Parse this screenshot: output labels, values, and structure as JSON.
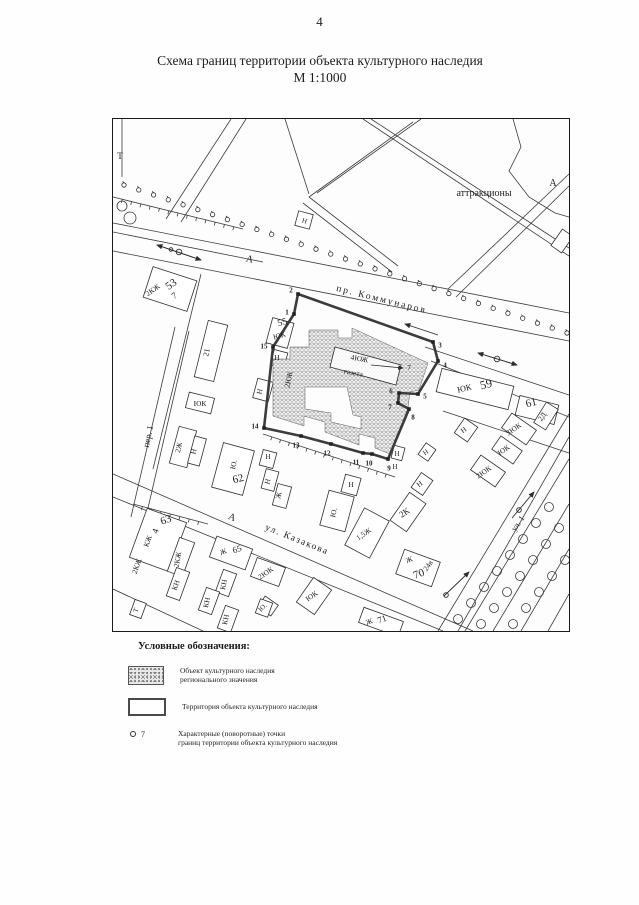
{
  "page": {
    "number": "4",
    "title_line1": "Схема границ территории объекта культурного наследия",
    "title_line2": "М 1:1000"
  },
  "legend": {
    "heading": "Условные обозначения:",
    "items": [
      {
        "swatch": "hatched-area",
        "label": "Объект культурного наследия\nрегионального значения"
      },
      {
        "swatch": "territory-outline",
        "label": "Территория объекта культурного наследия"
      },
      {
        "swatch": "turn-point",
        "marker_number": "7",
        "label": "Характерные (поворотные) точки\nграниц территории объекта культурного наследия"
      }
    ]
  },
  "map": {
    "labels": [
      {
        "t": "Т",
        "x": 7,
        "y": 40,
        "r": 0,
        "s": 9
      },
      {
        "t": "аттракционы",
        "x": 371,
        "y": 77,
        "r": 0,
        "s": 10
      },
      {
        "t": "А",
        "x": 440,
        "y": 67,
        "r": 0,
        "s": 10
      },
      {
        "t": "А",
        "x": 136,
        "y": 143,
        "r": 12,
        "s": 10
      },
      {
        "t": "пр.  Коммунаров",
        "x": 268,
        "y": 183,
        "r": 14,
        "s": 9.5,
        "sp": 2
      },
      {
        "t": "53",
        "x": 60,
        "y": 168,
        "r": -35,
        "s": 11
      },
      {
        "t": "2КЖ",
        "x": 41,
        "y": 173,
        "r": -35,
        "s": 7.5
      },
      {
        "t": "7",
        "x": 63,
        "y": 179,
        "r": -35,
        "s": 9
      },
      {
        "t": "21",
        "x": 96,
        "y": 234,
        "r": -78,
        "s": 8
      },
      {
        "t": "ЮК",
        "x": 87,
        "y": 287,
        "r": 0,
        "s": 7.5
      },
      {
        "t": "55",
        "x": 170,
        "y": 206,
        "r": -15,
        "s": 9.5
      },
      {
        "t": "ЮК",
        "x": 167,
        "y": 219,
        "r": -15,
        "s": 7.5
      },
      {
        "t": "Н",
        "x": 164,
        "y": 241,
        "r": 0,
        "s": 7.5
      },
      {
        "t": "Н",
        "x": 149,
        "y": 273,
        "r": -78,
        "s": 7.5
      },
      {
        "t": "2ЮК",
        "x": 178,
        "y": 261,
        "r": -78,
        "s": 7.5
      },
      {
        "t": "пер. 1",
        "x": 38,
        "y": 318,
        "r": -78,
        "s": 9
      },
      {
        "t": "2Ж",
        "x": 68,
        "y": 329,
        "r": -78,
        "s": 7.5
      },
      {
        "t": "Н",
        "x": 83,
        "y": 333,
        "r": -78,
        "s": 7.5
      },
      {
        "t": "Ю.",
        "x": 123,
        "y": 346,
        "r": -78,
        "s": 7.5
      },
      {
        "t": "62",
        "x": 126,
        "y": 363,
        "r": -15,
        "s": 11
      },
      {
        "t": "Н",
        "x": 155,
        "y": 340,
        "r": 0,
        "s": 7.5
      },
      {
        "t": "Н",
        "x": 157,
        "y": 363,
        "r": -78,
        "s": 7.5
      },
      {
        "t": "Ж",
        "x": 168,
        "y": 377,
        "r": -78,
        "s": 7.5
      },
      {
        "t": "А",
        "x": 118,
        "y": 401,
        "r": 20,
        "s": 10
      },
      {
        "t": "ул.  Казакова",
        "x": 183,
        "y": 423,
        "r": 22,
        "s": 9.5,
        "sp": 1.5
      },
      {
        "t": "63",
        "x": 54,
        "y": 404,
        "r": -20,
        "s": 11
      },
      {
        "t": "4",
        "x": 45,
        "y": 413,
        "r": -70,
        "s": 9
      },
      {
        "t": "КЖ",
        "x": 37,
        "y": 423,
        "r": -70,
        "s": 7.5
      },
      {
        "t": "2КЖ",
        "x": 26,
        "y": 448,
        "r": -70,
        "s": 7.5
      },
      {
        "t": "2КЖ",
        "x": 67,
        "y": 441,
        "r": -80,
        "s": 7.5
      },
      {
        "t": "КН",
        "x": 65,
        "y": 467,
        "r": -70,
        "s": 7.5
      },
      {
        "t": "Т",
        "x": 25,
        "y": 492,
        "r": -70,
        "s": 7
      },
      {
        "t": "Ж",
        "x": 111,
        "y": 435,
        "r": -20,
        "s": 7.5
      },
      {
        "t": "65",
        "x": 125,
        "y": 433,
        "r": -20,
        "s": 9
      },
      {
        "t": "2ЮК",
        "x": 154,
        "y": 456,
        "r": -35,
        "s": 7.5
      },
      {
        "t": "КН",
        "x": 113,
        "y": 466,
        "r": -78,
        "s": 7.5
      },
      {
        "t": "КН",
        "x": 96,
        "y": 484,
        "r": -78,
        "s": 7.5
      },
      {
        "t": "КН",
        "x": 115,
        "y": 501,
        "r": -78,
        "s": 7.5
      },
      {
        "t": "Ю.",
        "x": 151,
        "y": 490,
        "r": -45,
        "s": 7
      },
      {
        "t": "ЮК",
        "x": 200,
        "y": 479,
        "r": -35,
        "s": 7.5
      },
      {
        "t": "Ж",
        "x": 257,
        "y": 505,
        "r": -20,
        "s": 7.5
      },
      {
        "t": "71",
        "x": 270,
        "y": 503,
        "r": -20,
        "s": 9
      },
      {
        "t": "Ю.",
        "x": 223,
        "y": 394,
        "r": -78,
        "s": 7.5
      },
      {
        "t": "Н",
        "x": 238,
        "y": 368,
        "r": 0,
        "s": 7.5
      },
      {
        "t": "1,5Ж",
        "x": 252,
        "y": 417,
        "r": -35,
        "s": 7.5
      },
      {
        "t": "2К",
        "x": 293,
        "y": 396,
        "r": -35,
        "s": 9
      },
      {
        "t": "Н",
        "x": 308,
        "y": 367,
        "r": -35,
        "s": 7.5
      },
      {
        "t": "Н",
        "x": 284,
        "y": 337,
        "r": 0,
        "s": 7
      },
      {
        "t": "Н",
        "x": 282,
        "y": 350,
        "r": 0,
        "s": 7
      },
      {
        "t": "Н",
        "x": 314,
        "y": 335,
        "r": -35,
        "s": 7
      },
      {
        "t": "ЮК",
        "x": 352,
        "y": 272,
        "r": -14,
        "s": 8.5
      },
      {
        "t": "59",
        "x": 374,
        "y": 269,
        "r": -14,
        "s": 12
      },
      {
        "t": "61",
        "x": 419,
        "y": 287,
        "r": -14,
        "s": 11
      },
      {
        "t": "2Д",
        "x": 431,
        "y": 299,
        "r": -55,
        "s": 7.5
      },
      {
        "t": "3ЮК",
        "x": 402,
        "y": 312,
        "r": -35,
        "s": 7.5
      },
      {
        "t": "Н",
        "x": 352,
        "y": 313,
        "r": -35,
        "s": 7.5
      },
      {
        "t": "ЮК",
        "x": 392,
        "y": 333,
        "r": -35,
        "s": 7.5
      },
      {
        "t": "2ЮК",
        "x": 372,
        "y": 355,
        "r": -35,
        "s": 7.5
      },
      {
        "t": "Ж",
        "x": 297,
        "y": 443,
        "r": -20,
        "s": 7.5
      },
      {
        "t": "70",
        "x": 307,
        "y": 458,
        "r": -20,
        "s": 11
      },
      {
        "t": "24в",
        "x": 317,
        "y": 448,
        "r": -55,
        "s": 7.5
      },
      {
        "t": "ул. 1",
        "x": 407,
        "y": 406,
        "r": -55,
        "s": 8.5
      },
      {
        "t": "Н",
        "x": 191,
        "y": 104,
        "r": 15,
        "s": 7
      },
      {
        "t": "4ЮЖ",
        "x": 246,
        "y": 242,
        "r": 10,
        "s": 7.5
      },
      {
        "t": "газета",
        "x": 240,
        "y": 256,
        "r": 10,
        "s": 7.5
      },
      {
        "t": "7",
        "x": 296,
        "y": 251,
        "r": 0,
        "s": 7.5
      }
    ],
    "points": [
      {
        "n": "1",
        "x": 181,
        "y": 195,
        "lx": 174,
        "ly": 193
      },
      {
        "n": "2",
        "x": 185,
        "y": 175,
        "lx": 178,
        "ly": 171
      },
      {
        "n": "3",
        "x": 320,
        "y": 223,
        "lx": 327,
        "ly": 226
      },
      {
        "n": "4",
        "x": 325,
        "y": 242,
        "lx": 332,
        "ly": 246
      },
      {
        "n": "5",
        "x": 305,
        "y": 275,
        "lx": 312,
        "ly": 277
      },
      {
        "n": "6",
        "x": 286,
        "y": 274,
        "lx": 278,
        "ly": 272
      },
      {
        "n": "7",
        "x": 285,
        "y": 284,
        "lx": 277,
        "ly": 288
      },
      {
        "n": "8",
        "x": 296,
        "y": 290,
        "lx": 300,
        "ly": 298
      },
      {
        "n": "9",
        "x": 275,
        "y": 340,
        "lx": 276,
        "ly": 349
      },
      {
        "n": "10",
        "x": 259,
        "y": 335,
        "lx": 256,
        "ly": 344
      },
      {
        "n": "11",
        "x": 250,
        "y": 334,
        "lx": 243,
        "ly": 343
      },
      {
        "n": "12",
        "x": 218,
        "y": 325,
        "lx": 214,
        "ly": 334
      },
      {
        "n": "13",
        "x": 188,
        "y": 317,
        "lx": 183,
        "ly": 326
      },
      {
        "n": "14",
        "x": 151,
        "y": 309,
        "lx": 142,
        "ly": 307
      },
      {
        "n": "15",
        "x": 160,
        "y": 228,
        "lx": 151,
        "ly": 227
      }
    ]
  },
  "colors": {
    "ink": "#1f1f1f",
    "boundary": "#3c3c3c",
    "thin_line": "#3a3a3a",
    "stipple": "#787878"
  }
}
